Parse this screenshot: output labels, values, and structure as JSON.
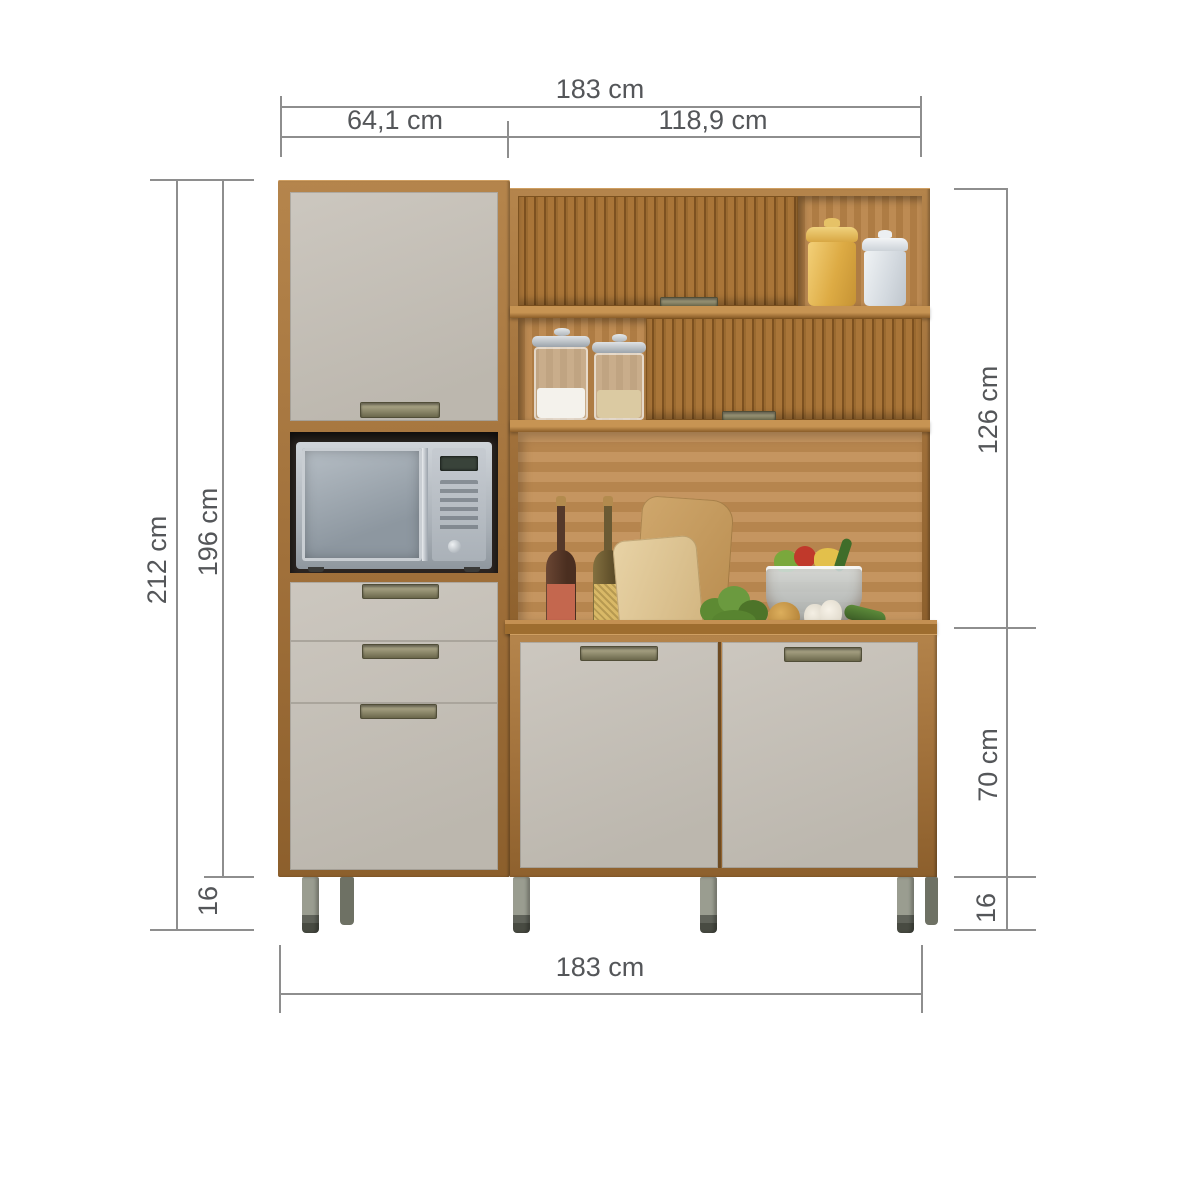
{
  "diagram": {
    "kind": "furniture-dimension-diagram",
    "product": "kitchen-cabinet-with-hutch",
    "dimensions": {
      "top_total": "183 cm",
      "top_left_section": "64,1 cm",
      "top_right_section": "118,9 cm",
      "left_total_height": "212 cm",
      "left_body_height": "196 cm",
      "left_feet_height": "16",
      "right_upper_height": "126 cm",
      "right_lower_height": "70 cm",
      "right_feet_height": "16",
      "bottom_total": "183 cm"
    },
    "colors": {
      "wood_frame": "#a0703a",
      "wood_slats": "#9a6a30",
      "back_panel": "#c08c52",
      "door_gray": "#ccc7bf",
      "dimension_line": "#8e8e8e",
      "dimension_text": "#545659",
      "leg_metal": "#9a9d90"
    },
    "decor_items": [
      "microwave",
      "yellow-canister",
      "white-canister",
      "glass-jar-salt",
      "glass-jar-grains",
      "bottle-red-label",
      "bottle-yellow-label",
      "cutting-board-back",
      "cutting-board-front",
      "herb-bunch",
      "salad-bowl",
      "onion",
      "garlic-bulb",
      "cucumber"
    ]
  }
}
